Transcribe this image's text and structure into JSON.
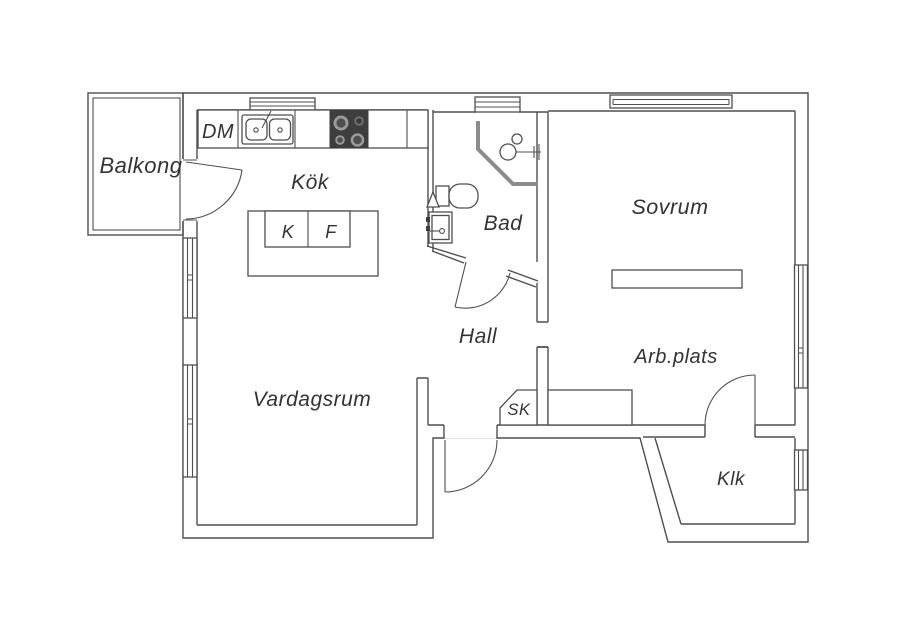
{
  "plan": {
    "title": "Apartment floor plan",
    "colors": {
      "background": "#ffffff",
      "wall": "#4f4f4f",
      "label": "#333333",
      "shower_glass": "#8c8c8c",
      "stove_body": "#3e3e3e"
    },
    "rooms": {
      "balkong": {
        "label": "Balkong"
      },
      "kok": {
        "label": "Kök"
      },
      "bad": {
        "label": "Bad"
      },
      "sovrum": {
        "label": "Sovrum"
      },
      "hall": {
        "label": "Hall"
      },
      "vardagsrum": {
        "label": "Vardagsrum"
      },
      "arbplats": {
        "label": "Arb.plats"
      },
      "sk": {
        "label": "SK"
      },
      "klk": {
        "label": "Klk"
      }
    },
    "appliances": {
      "dishwasher": {
        "label": "DM"
      },
      "fridge": {
        "label": "K"
      },
      "freezer": {
        "label": "F"
      }
    }
  }
}
